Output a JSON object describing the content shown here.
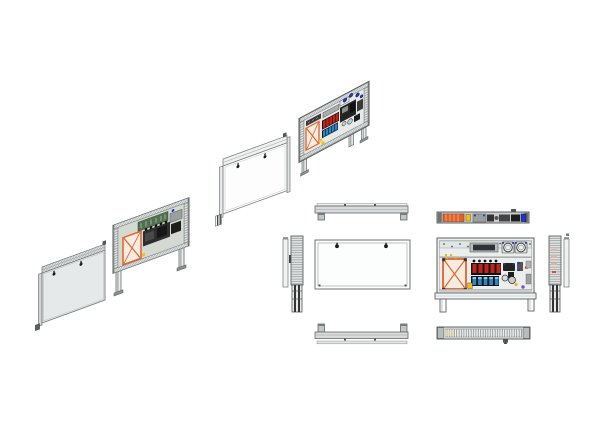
{
  "document": {
    "kind": "cad-multiview-drawing",
    "subject": "wall-mount electrical control panel: exploded isometric views (door + open chassis) and orthographic projections (top, front, left, right, bottom) of door and open chassis"
  },
  "colors": {
    "background": "#ffffff",
    "frame_gray": "#c9cdcd",
    "frame_light": "#e6e9e9",
    "line_gray": "#6a6e6e",
    "interior_light": "#eceeee",
    "interior_green": "#d4dad2",
    "transformer_orange": "#e2622b",
    "transformer_fill": "#f6ece2",
    "breaker_red": "#c22418",
    "terminal_blue": "#2a86c8",
    "terminal_cyan": "#7ad0e8",
    "accent_yellow": "#f0c020",
    "indicator_blue": "#2233cc",
    "accent_purple": "#7a50c8",
    "pcb_green": "#51704f",
    "component_black": "#242424",
    "screen_dark": "#2e3236"
  },
  "components": {
    "breaker_count": 5,
    "terminal_block_count": 5,
    "fan_count": 2,
    "door_knob_count": 2,
    "mounting_leg_count": 2
  },
  "views": {
    "iso_door_far_left": "door-panel-isometric",
    "iso_open_left": "open-chassis-isometric-rear",
    "iso_door_middle": "door-panel-isometric-2",
    "iso_open_upper": "open-chassis-isometric-front",
    "ortho_top_door": "door-top-view",
    "ortho_top_open": "chassis-top-view",
    "ortho_front_door": "door-front-view",
    "ortho_front_open": "chassis-front-view",
    "ortho_side_left": "left-side-view",
    "ortho_side_right": "right-side-view",
    "ortho_bottom_door": "door-bottom-view",
    "ortho_bottom_open": "chassis-bottom-view"
  }
}
